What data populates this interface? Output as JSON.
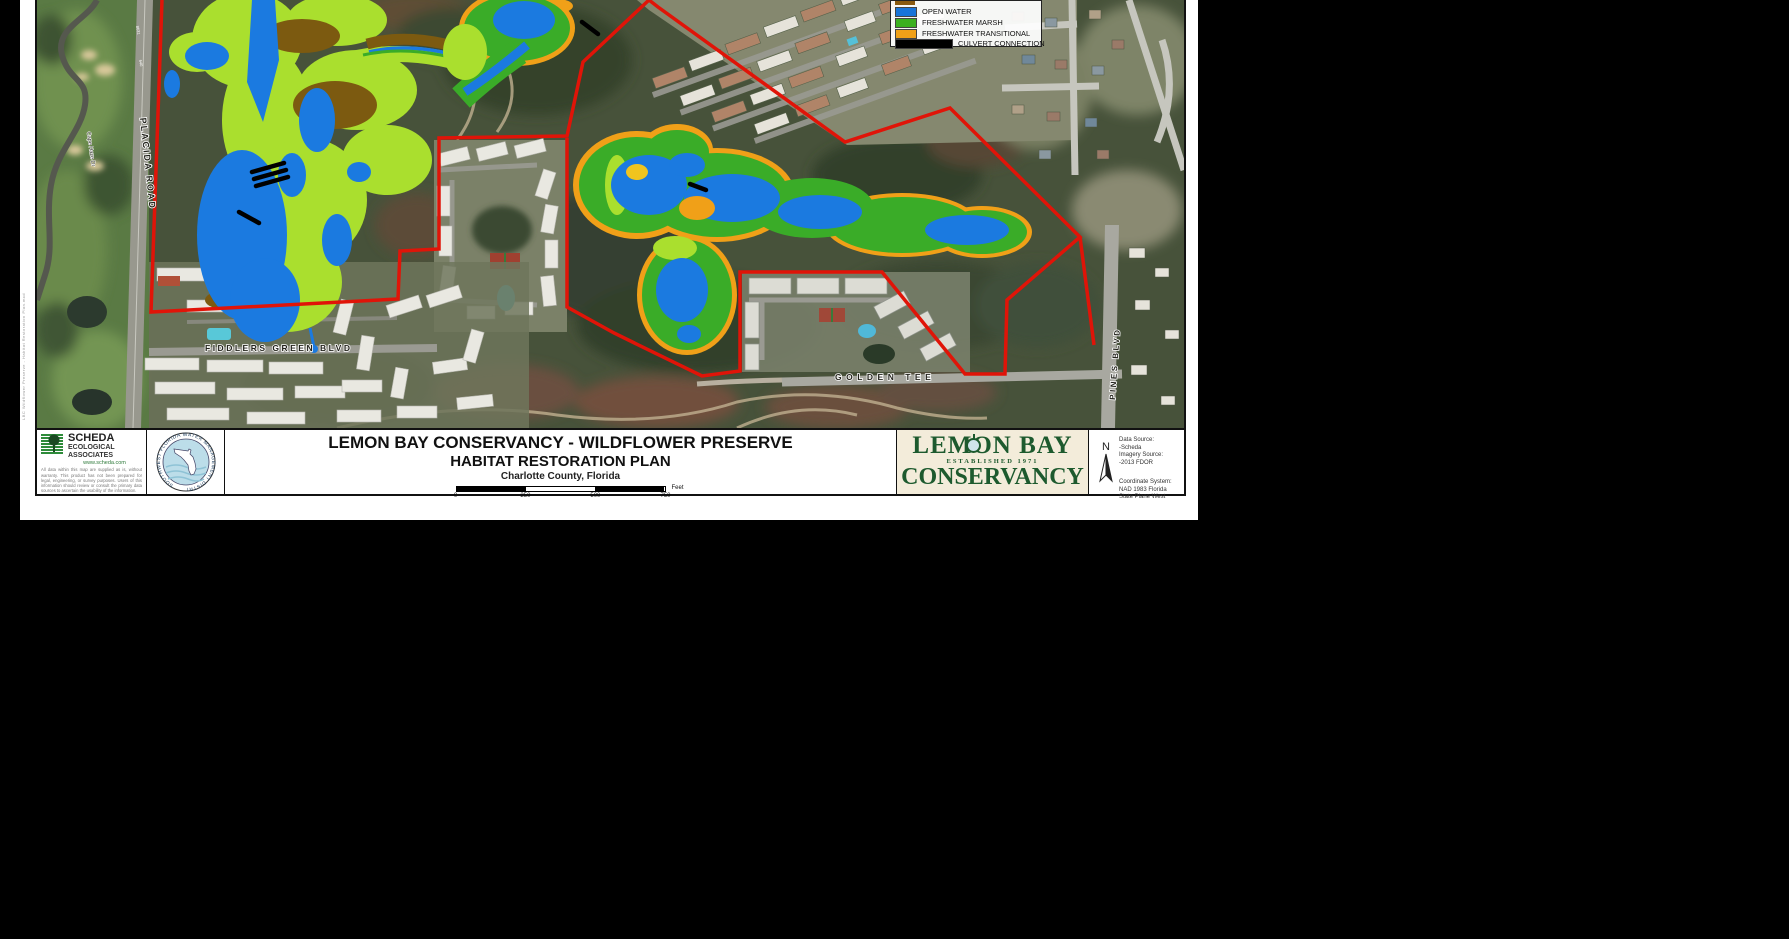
{
  "margin_note": "LBC Wildflower Preserve - Habitat Restoration Plan.mxd",
  "legend": {
    "items": [
      {
        "label": "OPEN WATER",
        "color": "#1874d8"
      },
      {
        "label": "FRESHWATER MARSH",
        "color": "#3cb020"
      },
      {
        "label": "FRESHWATER TRANSITIONAL",
        "color": "#f0a018"
      },
      {
        "label": "CULVERT CONNECTION",
        "color": "#000000"
      }
    ]
  },
  "map_labels": {
    "placida_road": "PLACIDA ROAD",
    "fiddlers_green": "FIDDLERS GREEN BLVD",
    "golden_tee": "GOLDEN TEE",
    "pines_blvd": "PINES BLVD",
    "cape_haze": "Cape Haze Dr",
    "marker_8631": "8631",
    "marker_640": "640"
  },
  "map_colors": {
    "open_water": "#1b7ae0",
    "freshwater_marsh": "#3aac28",
    "freshwater_marsh_light": "#aadf2e",
    "freshwater_transitional": "#f0a018",
    "boundary_red": "#e01408",
    "brown_habitat": "#7c5a10"
  },
  "title_block": {
    "scheda": {
      "name": "SCHEDA",
      "line2": "ECOLOGICAL",
      "line3": "ASSOCIATES",
      "url": "www.scheda.com",
      "disclaimer": "All data within this map are supplied as is, without warranty. This product has not been prepared for legal, engineering, or survey purposes. Users of this information should review or consult the primary data sources to ascertain the usability of the information."
    },
    "seal_text": "SOUTHWEST FLORIDA WATER MANAGEMENT DISTRICT",
    "title_line1": "LEMON BAY CONSERVANCY - WILDFLOWER PRESERVE",
    "title_line2": "HABITAT RESTORATION PLAN",
    "title_line3": "Charlotte County, Florida",
    "scale": {
      "ticks": [
        "0",
        "250",
        "500",
        "750"
      ],
      "unit": "Feet"
    },
    "lbc": {
      "line1": "LEMON BAY",
      "line2": "ESTABLISHED 1971",
      "line3": "CONSERVANCY"
    },
    "north_label": "N",
    "sources": {
      "l1": "Data Source:",
      "l2": "-Scheda",
      "l3": "Imagery Source:",
      "l4": "-2013 FDOR",
      "l5": "Coordinate System:",
      "l6": "NAD 1983 Florida",
      "l7": "State Plane West"
    }
  }
}
